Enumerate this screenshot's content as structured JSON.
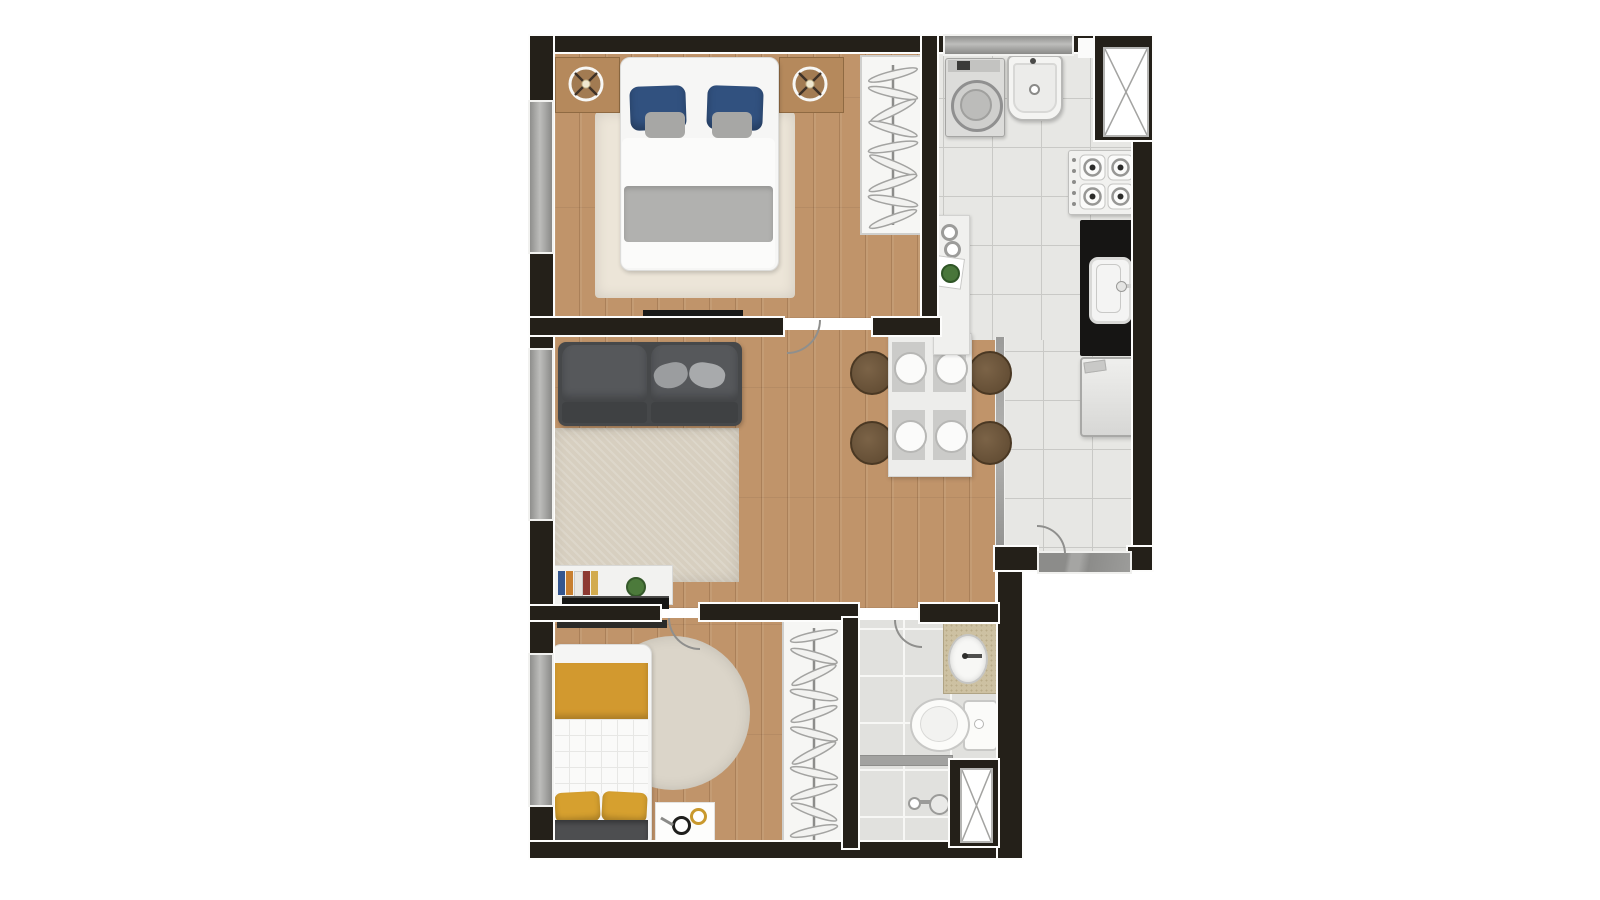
{
  "meta": {
    "type": "apartment-floor-plan",
    "style": "top-down furnished 3D render, 1-bedroom-plus-suite unit, no text labels visible",
    "visible_text": "none"
  },
  "palette": {
    "background": "#ffffff",
    "wall": "#242019",
    "wall_outline": "#fdfdfc",
    "wood_floor": "#c0946a",
    "kitchen_tile": "#e7e7e4",
    "bathroom_tile": "#e1e1de",
    "window_glass_gray": "#a9a9a7",
    "rug_cream": "#ece5d8",
    "rug_beige": "#d7cfc0",
    "rug_round": "#dbd5c9",
    "sofa_gray": "#4b4d4f",
    "pillow_navy": "#31517f",
    "blanket_gray": "#b1b1af",
    "accent_mustard": "#d2992f",
    "dark_blanket": "#4d4e50",
    "counter_black": "#161514",
    "counter_granite_beige": "#cdc1a2",
    "furniture_white": "#f2f2f0",
    "chair_wood": "#6d5740",
    "nightstand_wood": "#b5895c"
  },
  "rooms": [
    {
      "id": "bedroom-1",
      "position": "top-left",
      "floor": "wood",
      "furniture": [
        "double-bed",
        "navy-pillows",
        "gray-throw-blanket",
        "cream-area-rug",
        "nightstand-left",
        "nightstand-right",
        "table-lamp-left",
        "table-lamp-right",
        "open-wardrobe-with-hangers",
        "wall-tv"
      ],
      "windows": 1,
      "doors": 1
    },
    {
      "id": "kitchen-laundry",
      "position": "right-column",
      "floor": "ceramic-tile",
      "furniture": [
        "washing-machine",
        "laundry-tank-sink",
        "gas-cooktop",
        "black-stone-counter-with-sink",
        "refrigerator",
        "peninsula-counter",
        "entry-threshold"
      ],
      "windows": 1,
      "doors": 1,
      "service_shaft": true
    },
    {
      "id": "living-dining",
      "position": "center-left",
      "floor": "wood",
      "furniture": [
        "two-seat-sofa",
        "throw-pillows",
        "beige-rug",
        "tv-stand-with-books-and-plant",
        "tv",
        "dining-table",
        "dining-chairs",
        "place-settings"
      ],
      "windows": 1
    },
    {
      "id": "bedroom-2",
      "position": "bottom-left",
      "floor": "wood",
      "furniture": [
        "single-bed-mustard-bedding",
        "round-rug",
        "wall-shelf",
        "floor-mat-with-bowls",
        "open-closet-with-hangers"
      ],
      "windows": 1,
      "doors": 1
    },
    {
      "id": "bathroom",
      "position": "bottom-right",
      "floor": "ceramic-tile",
      "furniture": [
        "granite-vanity-with-oval-sink",
        "toilet",
        "shower-area",
        "shower-head",
        "glass-divider"
      ],
      "doors": 1,
      "service_shaft": true
    }
  ],
  "counts": {
    "wardrobe1_hangers": 9,
    "closet2_hangers": 11,
    "cooktop_burners": 4,
    "dining_chairs": 4,
    "place_settings": 4,
    "windows_total": 4,
    "door_swings": 4,
    "service_shafts": 2,
    "sofa_seats": 2,
    "bed1_pillows_navy": 2,
    "bed1_pillows_gray": 2,
    "bed2_pillows_yellow": 2
  }
}
